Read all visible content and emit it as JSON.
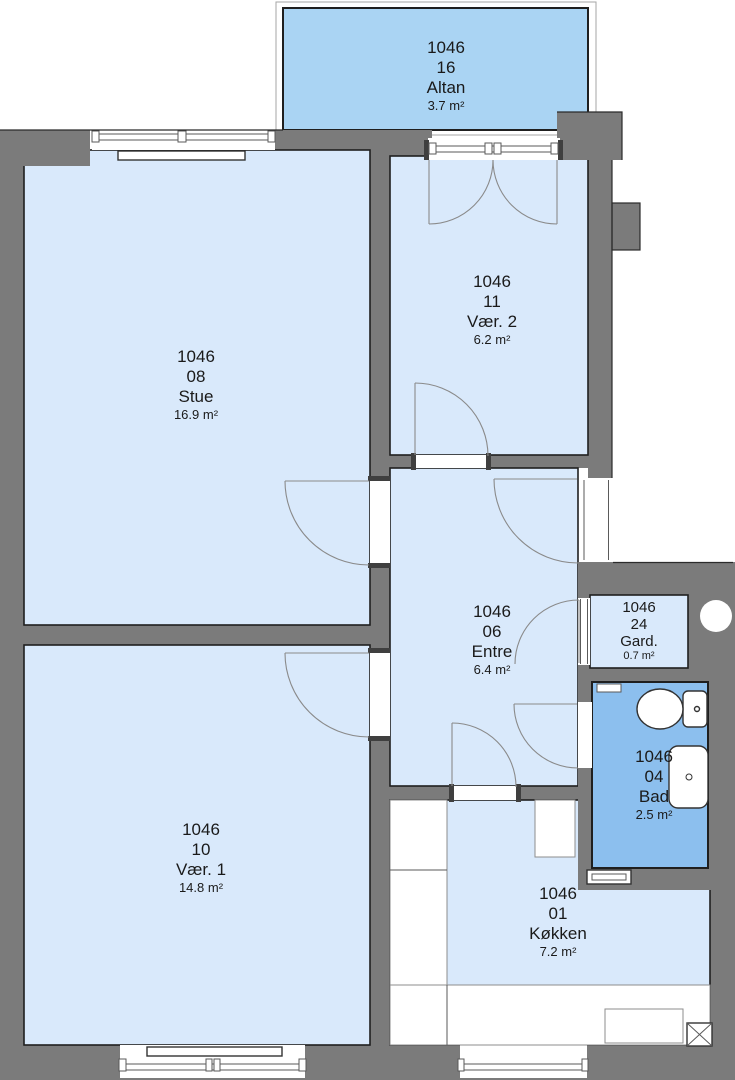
{
  "plan": {
    "apartment_id": "1046",
    "rooms": [
      {
        "key": "altan",
        "apartment": "1046",
        "number": "16",
        "name": "Altan",
        "area": "3.7 m²"
      },
      {
        "key": "stue",
        "apartment": "1046",
        "number": "08",
        "name": "Stue",
        "area": "16.9 m²"
      },
      {
        "key": "vaer2",
        "apartment": "1046",
        "number": "11",
        "name": "Vær. 2",
        "area": "6.2 m²"
      },
      {
        "key": "entre",
        "apartment": "1046",
        "number": "06",
        "name": "Entre",
        "area": "6.4 m²"
      },
      {
        "key": "gard",
        "apartment": "1046",
        "number": "24",
        "name": "Gard.",
        "area": "0.7 m²"
      },
      {
        "key": "bad",
        "apartment": "1046",
        "number": "04",
        "name": "Bad",
        "area": "2.5 m²"
      },
      {
        "key": "vaer1",
        "apartment": "1046",
        "number": "10",
        "name": "Vær. 1",
        "area": "14.8 m²"
      },
      {
        "key": "koekken",
        "apartment": "1046",
        "number": "01",
        "name": "Køkken",
        "area": "7.2 m²"
      }
    ],
    "colors": {
      "wall": "#7b7b7b",
      "room_fill": "#d9e9fb",
      "wet_room_fill": "#8cbfee",
      "balcony_fill": "#aad4f3",
      "outline": "#1f1f1f",
      "background": "#ffffff"
    }
  }
}
